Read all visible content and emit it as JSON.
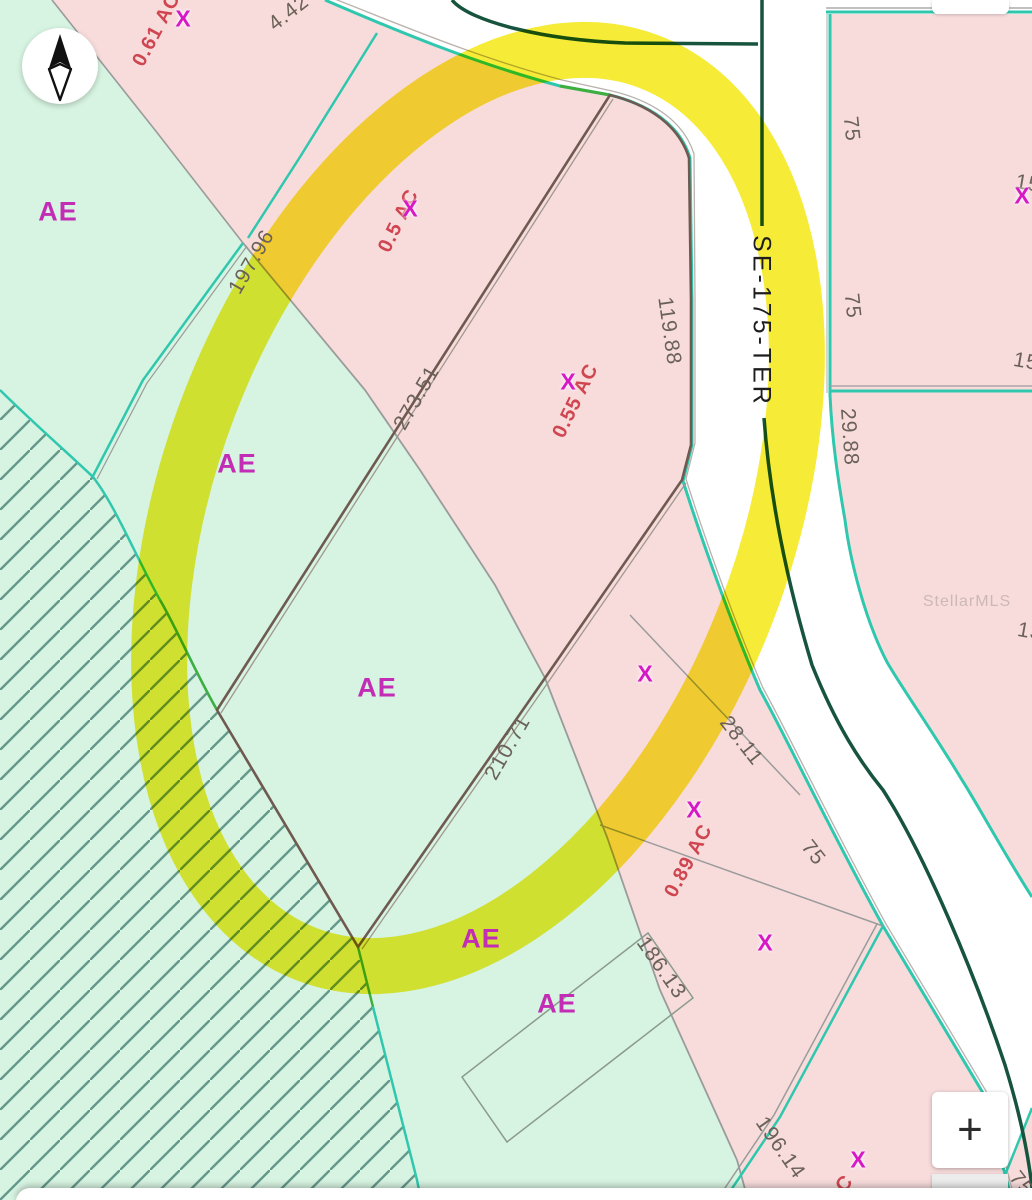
{
  "map": {
    "street": {
      "name": "SE-175-TER"
    },
    "watermark": "StellarMLS",
    "flood_zone_label": "AE",
    "parcel_marker": "X",
    "dimensions": {
      "top_442": "4.42",
      "west_19796": "197.96",
      "nw_27351": "273.51",
      "road_11988": "119.88",
      "se_21071": "210.71",
      "side_2811": "28.11",
      "south_18613": "186.13",
      "south_19614": "196.14",
      "east_2988": "29.88",
      "frontage_75": "75",
      "clip_15": "15",
      "clip_13": "13"
    },
    "acreage": {
      "a_061": "0.61 AC",
      "a_05": "0.5 AC",
      "a_055": "0.55 AC",
      "a_089": "0.89 AC",
      "clip_c": "C"
    },
    "colors": {
      "flood_ae_green": "#d7f3e1",
      "flood_x_pink": "#f8dcdc",
      "boundary_teal": "#2fc7ae",
      "bright_green_line": "#3fae3f",
      "road_centerline": "#17543e",
      "subject_parcel_brown": "#6e5a50",
      "highlight_yellow": "#f4e70b",
      "zone_label_magenta": "#c32cb5",
      "acreage_red": "#cf4550",
      "dimension_gray": "#6a6158"
    }
  },
  "controls": {
    "zoom_in_label": "+"
  }
}
